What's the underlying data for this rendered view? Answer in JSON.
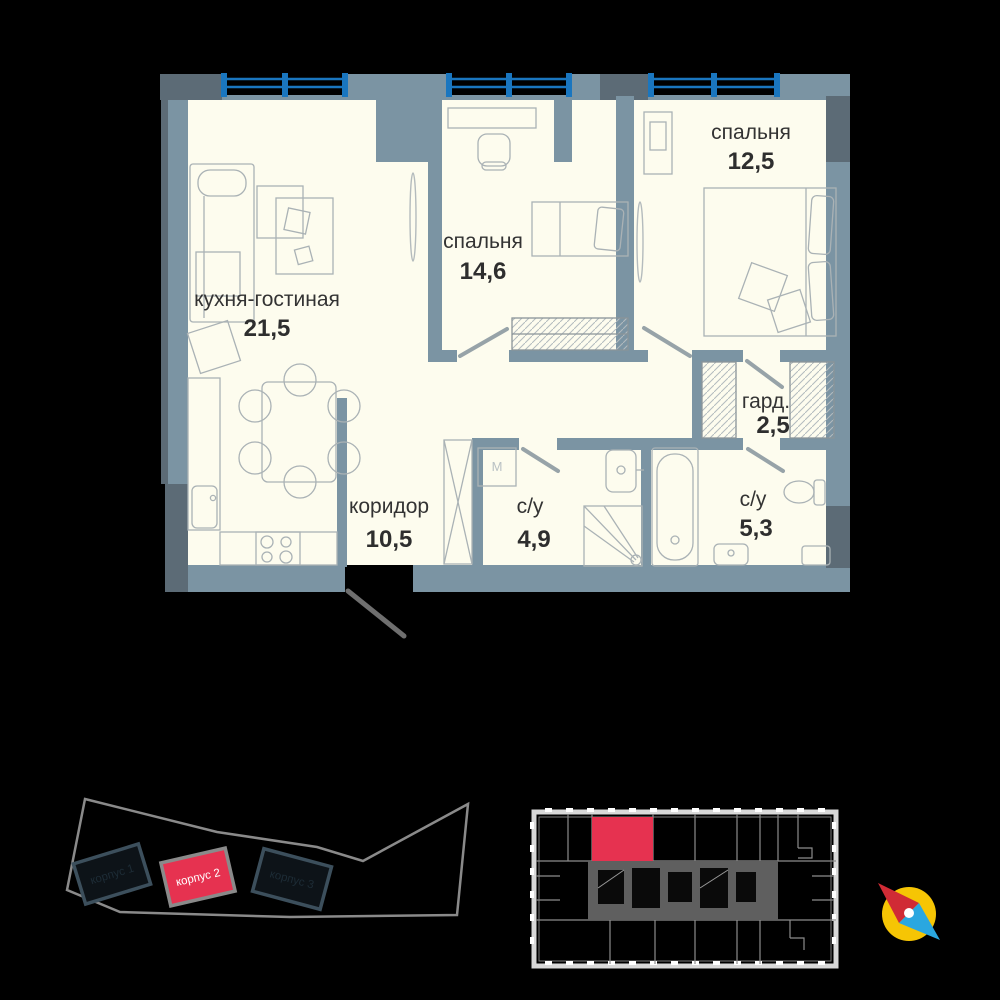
{
  "plan": {
    "rooms": [
      {
        "name": "кухня-гостиная",
        "area": "21,5"
      },
      {
        "name": "спальня",
        "area": "14,6"
      },
      {
        "name": "спальня",
        "area": "12,5"
      },
      {
        "name": "гард.",
        "area": "2,5"
      },
      {
        "name": "коридор",
        "area": "10,5"
      },
      {
        "name": "с/у",
        "area": "4,9"
      },
      {
        "name": "с/у",
        "area": "5,3"
      }
    ],
    "washer_label": "М",
    "colors": {
      "wall": "#7b94a3",
      "wall_dark": "#5c6b76",
      "floor": "#fdfcee",
      "railing": "#1a76bf",
      "furniture_line": "#aab2b5",
      "label": "#333333"
    }
  },
  "site_plan": {
    "buildings": [
      {
        "label": "корпус 1",
        "highlighted": false
      },
      {
        "label": "корпус 2",
        "highlighted": true
      },
      {
        "label": "корпус 3",
        "highlighted": false
      }
    ],
    "highlight_color": "#e63250",
    "outline_color": "#8a8a8a",
    "building_outline": "#3c4f5c"
  },
  "key_plan": {
    "highlight_color": "#e63250",
    "wall_color": "#d9d9d9",
    "core_color": "#5f5f5f"
  },
  "compass": {
    "north_color": "#d02b35",
    "south_color": "#2aa7e0",
    "dial_color": "#f6c504"
  }
}
